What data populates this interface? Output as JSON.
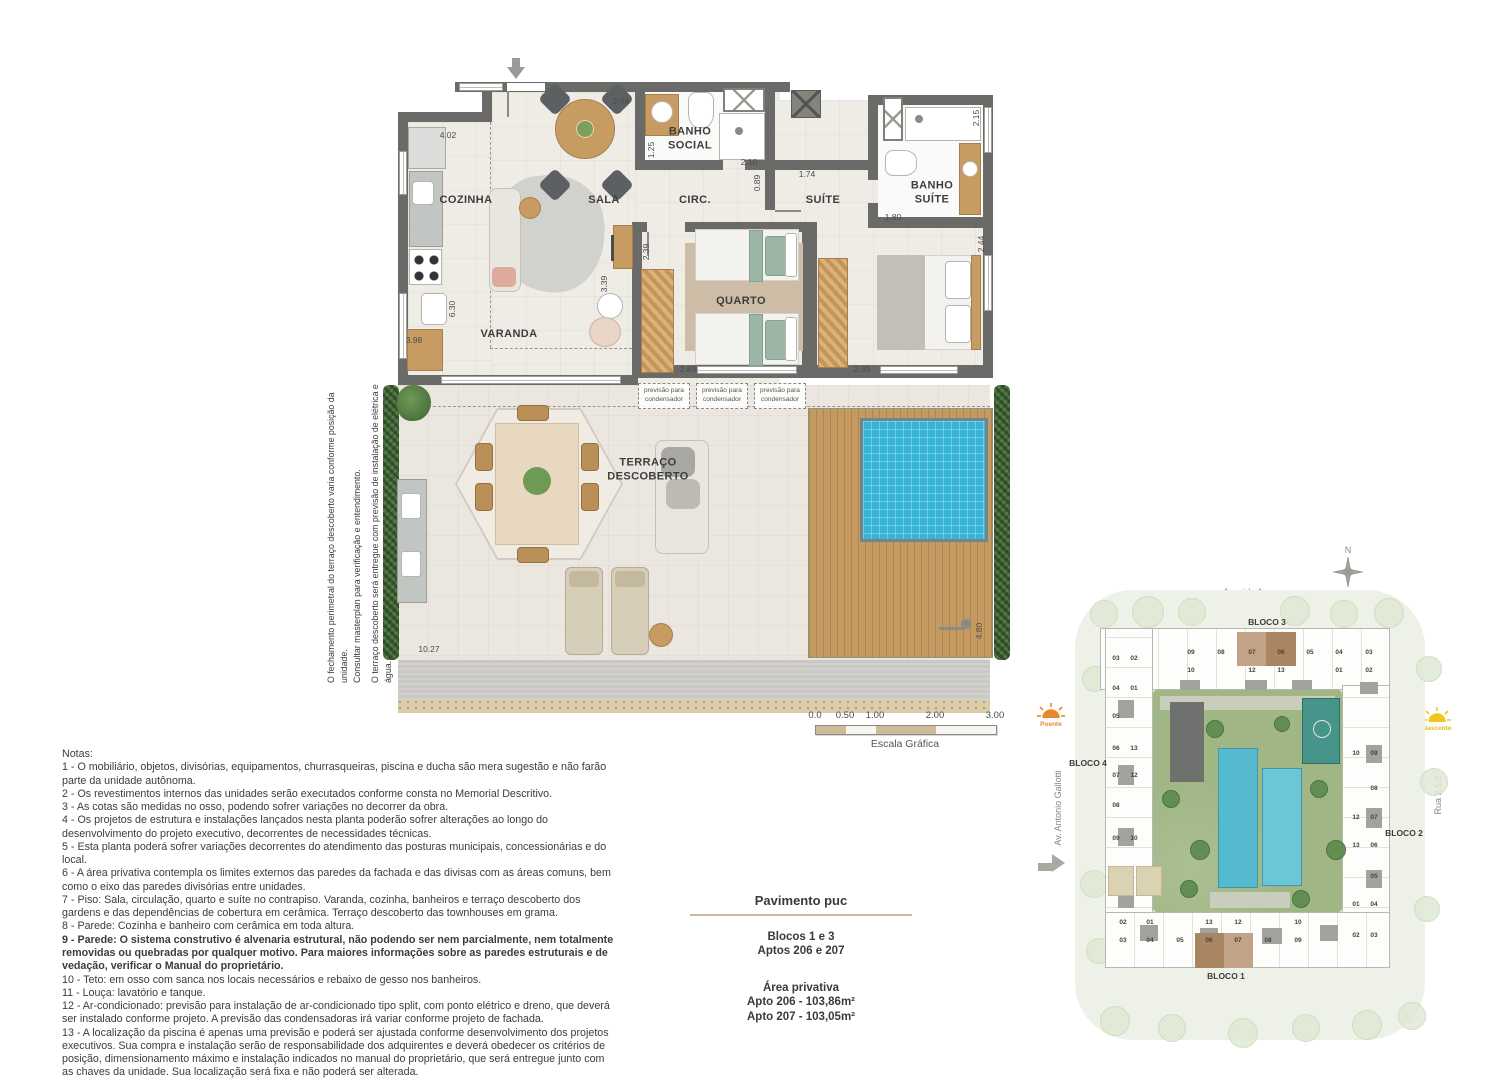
{
  "plan": {
    "rooms": {
      "cozinha": "COZINHA",
      "sala": "SALA",
      "circ": "CIRC.",
      "suite": "SUÍTE",
      "banho_social": "BANHO\nSOCIAL",
      "banho_suite": "BANHO\nSUÍTE",
      "quarto": "QUARTO",
      "varanda": "VARANDA",
      "terraco": "TERRAÇO\nDESCOBERTO"
    },
    "dims": [
      "4.02",
      "2.44",
      "1.25",
      "2.10",
      "0.89",
      "1.74",
      "2.15",
      "1.80",
      "2.44",
      "2.39",
      "3.39",
      "6.30",
      "3.98",
      "2.89",
      "2.99",
      "10.27",
      "4.80"
    ],
    "condenser_label": "previsão para\ncondensador",
    "side_notes": [
      "O fechamento perimetral do terraço descoberto varia conforme posição da unidade.",
      "Consultar masterplan para verificação e entendimento.",
      "O terraço descoberto será entregue com previsão de instalação de elétrica e água."
    ]
  },
  "scale_bar": {
    "ticks": [
      "0.0",
      "0.50",
      "1.00",
      "2.00",
      "3.00"
    ],
    "label": "Escala Gráfica"
  },
  "notes": {
    "title": "Notas:",
    "bold_index": 8,
    "items": [
      "1 - O mobiliário, objetos, divisórias, equipamentos, churrasqueiras, piscina e ducha são mera sugestão e não farão parte da unidade autônoma.",
      "2 - Os revestimentos internos das unidades serão executados conforme consta no Memorial Descritivo.",
      "3 - As cotas são medidas no osso, podendo sofrer variações no decorrer da obra.",
      "4 - Os projetos de estrutura e instalações lançados nesta planta poderão sofrer alterações ao longo do desenvolvimento do projeto executivo, decorrentes de necessidades técnicas.",
      "5 - Esta planta poderá sofrer variações decorrentes do atendimento das posturas municipais, concessionárias e do local.",
      "6 - A área privativa contempla os limites externos das paredes da fachada e das divisas com as áreas comuns, bem como o eixo das paredes divisórias entre unidades.",
      "7 - Piso: Sala, circulação, quarto e suíte no contrapiso. Varanda, cozinha, banheiros e terraço descoberto dos gardens e das dependências de cobertura em cerâmica. Terraço descoberto das townhouses em grama.",
      "8 - Parede: Cozinha e banheiro com cerâmica em toda altura.",
      "9 - Parede: O sistema construtivo é alvenaria estrutural, não podendo ser nem parcialmente, nem totalmente removidas ou quebradas por qualquer motivo. Para maiores informações sobre as paredes estruturais e de vedação, verificar o Manual do proprietário.",
      "10 - Teto: em osso com sanca nos locais necessários e rebaixo de gesso nos banheiros.",
      "11 - Louça: lavatório e tanque.",
      "12 - Ar-condicionado: previsão para instalação de ar-condicionado tipo split, com ponto elétrico e dreno, que deverá ser instalado conforme projeto. A previsão das condensadoras irá variar conforme projeto de fachada.",
      "13 - A localização da piscina é apenas uma previsão e poderá ser ajustada conforme desenvolvimento dos projetos executivos. Sua compra e instalação serão de responsabilidade dos adquirentes e deverá obedecer os critérios de posição, dimensionamento máximo e instalação indicados no manual do proprietário, que será entregue junto com as chaves da unidade. Sua localização será fixa e não poderá ser alterada."
    ]
  },
  "info": {
    "title": "Pavimento puc",
    "line1": "Blocos 1 e 3",
    "line2": "Aptos 206 e 207",
    "area_title": "Área privativa",
    "area1": "Apto 206 - 103,86m²",
    "area2": "Apto 207 - 103,05m²"
  },
  "site": {
    "compass": "N",
    "streets": {
      "top": "Avenida 1",
      "right": "Rua 2.5.2",
      "bottom": "Rua 2.5.1",
      "left": "Av. Antonio Gallotti"
    },
    "suns": {
      "west": "Poente",
      "east": "Nascente"
    },
    "blocks": {
      "b1": "BLOCO 1",
      "b2": "BLOCO 2",
      "b3": "BLOCO 3",
      "b4": "BLOCO 4"
    },
    "units": {
      "top_row1": [
        "09",
        "08",
        "07",
        "06",
        "05",
        "04",
        "03"
      ],
      "top_row1_hl": {
        "2": "light",
        "3": "dark"
      },
      "top_row2": [
        {
          "n": "10",
          "c": 0
        },
        {
          "n": "12",
          "c": 2
        },
        {
          "n": "13",
          "c": 3
        },
        {
          "n": "01",
          "c": 5
        },
        {
          "n": "02",
          "c": 6
        }
      ],
      "left_rows": [
        [
          "03",
          "02"
        ],
        [
          "04",
          "01"
        ],
        [
          "05"
        ],
        [
          "06",
          "13"
        ],
        [
          "07",
          "12"
        ],
        [
          "08"
        ],
        [
          "09",
          "10"
        ]
      ],
      "right_rows": [
        [
          "10",
          "09"
        ],
        [
          "08"
        ],
        [
          "12",
          "07"
        ],
        [
          "13",
          "06"
        ],
        [
          "05"
        ],
        [
          "01",
          "04"
        ],
        [
          "02",
          "03"
        ]
      ],
      "bottom_row1": [
        {
          "n": "02",
          "c": 0
        },
        {
          "n": "01",
          "c": 1
        },
        {
          "n": "13",
          "c": 3
        },
        {
          "n": "12",
          "c": 4
        },
        {
          "n": "10",
          "c": 6
        }
      ],
      "bottom_row2": [
        "03",
        "04",
        "05",
        "06",
        "07",
        "08",
        "09"
      ],
      "bottom_row2_hl": {
        "3": "dark",
        "4": "light"
      }
    }
  },
  "colors": {
    "wall": "#6a6a68",
    "pool": "#36b3d5",
    "deck": "#c59a60",
    "hedge": "#46683c",
    "highlight_dark": "#aa8561",
    "highlight_light": "#c2a388",
    "sun_west": "#e8882c",
    "sun_east": "#eec81e",
    "scale_tan": "#cdbb97"
  }
}
